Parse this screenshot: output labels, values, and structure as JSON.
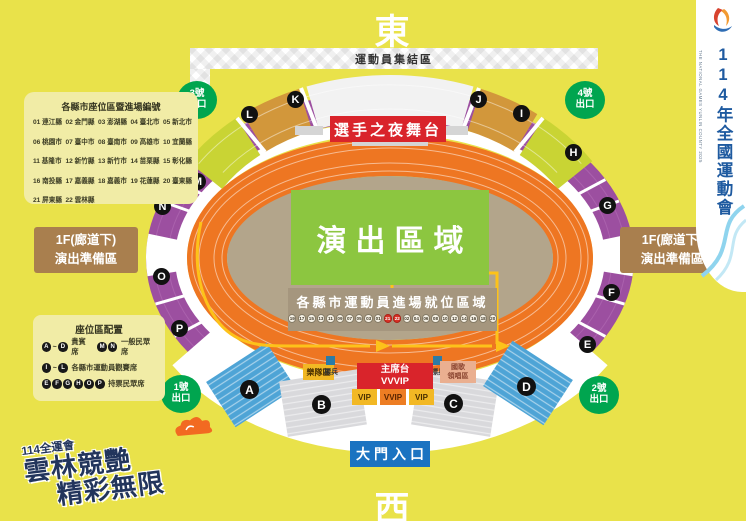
{
  "compass": {
    "east": "東",
    "west": "西"
  },
  "side_banner": {
    "title": "114年全國運動會",
    "subtitle_en": "THE NATIONAL GAMES YUNLIN COUNTY 2025"
  },
  "event_logo": {
    "prefix": "114全運會",
    "line1": "雲林競艷",
    "line2": "精彩無限"
  },
  "county_panel": {
    "title": "各縣市座位區暨進場編號",
    "items": [
      "01 連江縣",
      "02 金門縣",
      "03 澎湖縣",
      "04 臺北市",
      "05 新北市",
      "06 桃園市",
      "07 臺中市",
      "08 臺南市",
      "09 高雄市",
      "10 宜蘭縣",
      "11 基隆市",
      "12 新竹縣",
      "13 新竹市",
      "14 苗栗縣",
      "15 彰化縣",
      "16 南投縣",
      "17 嘉義縣",
      "18 嘉義市",
      "19 花蓮縣",
      "20 臺東縣",
      "21 屏東縣",
      "22 雲林縣"
    ]
  },
  "prep_area_left": "1F(廊道下)\n演出準備區",
  "prep_area_right": "1F(廊道下)\n演出準備區",
  "legend": {
    "title": "座位區配置",
    "rows": [
      [
        {
          "seats": "A ~ D",
          "label": "貴賓席"
        },
        {
          "seats": "M N",
          "label": "一般民眾席"
        }
      ],
      [
        {
          "seats": "I ~ L",
          "label": "各縣市運動員觀賽席"
        }
      ],
      [
        {
          "seats": "E F G H O P",
          "label": "持票民眾席"
        }
      ]
    ]
  },
  "stadium": {
    "assembly_banner": "運動員集結區",
    "stage": "選手之夜舞台",
    "performance_area": "演出區域",
    "lineup_title": "各縣市運動員進場就位區域",
    "lineup_numbers": [
      "19",
      "17",
      "15",
      "13",
      "11",
      "09",
      "07",
      "05",
      "03",
      "01",
      "21",
      "22",
      "02",
      "04",
      "06",
      "08",
      "10",
      "12",
      "14",
      "16",
      "18",
      "20"
    ],
    "lineup_highlight": [
      "21",
      "22"
    ],
    "ring_letters": [
      "L",
      "K",
      "J",
      "I",
      "M",
      "N",
      "O",
      "P",
      "H",
      "G",
      "F",
      "E"
    ],
    "stand_letters": [
      "A",
      "B",
      "C",
      "D"
    ],
    "ceremony": {
      "band_area": "樂隊區",
      "marker_label": "標兵",
      "chairman": "主席台\nVVVIP",
      "vip": "VIP",
      "vvip": "VVIP",
      "anthem": "國歌\n領唱區"
    },
    "main_gate": "大門入口",
    "exits": [
      "3號\n出口",
      "4號\n出口",
      "1號\n出口",
      "2號\n出口"
    ]
  },
  "colors": {
    "background": "#e9e24a",
    "track": "#ee7622",
    "ring_purple": "#9c4fa0",
    "stands_green": "#c9d434",
    "stands_orange": "#d2973b",
    "field_tan": "#b3a58b",
    "performance_green": "#8cc640",
    "accent_red": "#d9242b",
    "exit_green": "#00a54f",
    "gate_blue": "#1b73c1",
    "vip_yellow": "#f2b824",
    "vvip_orange": "#ed7d23",
    "prep_brown": "#a97f4e",
    "banner_blue": "#1e5aa0",
    "path_yellow": "#fdc21a",
    "stand_blue": "#4ea4d6"
  }
}
